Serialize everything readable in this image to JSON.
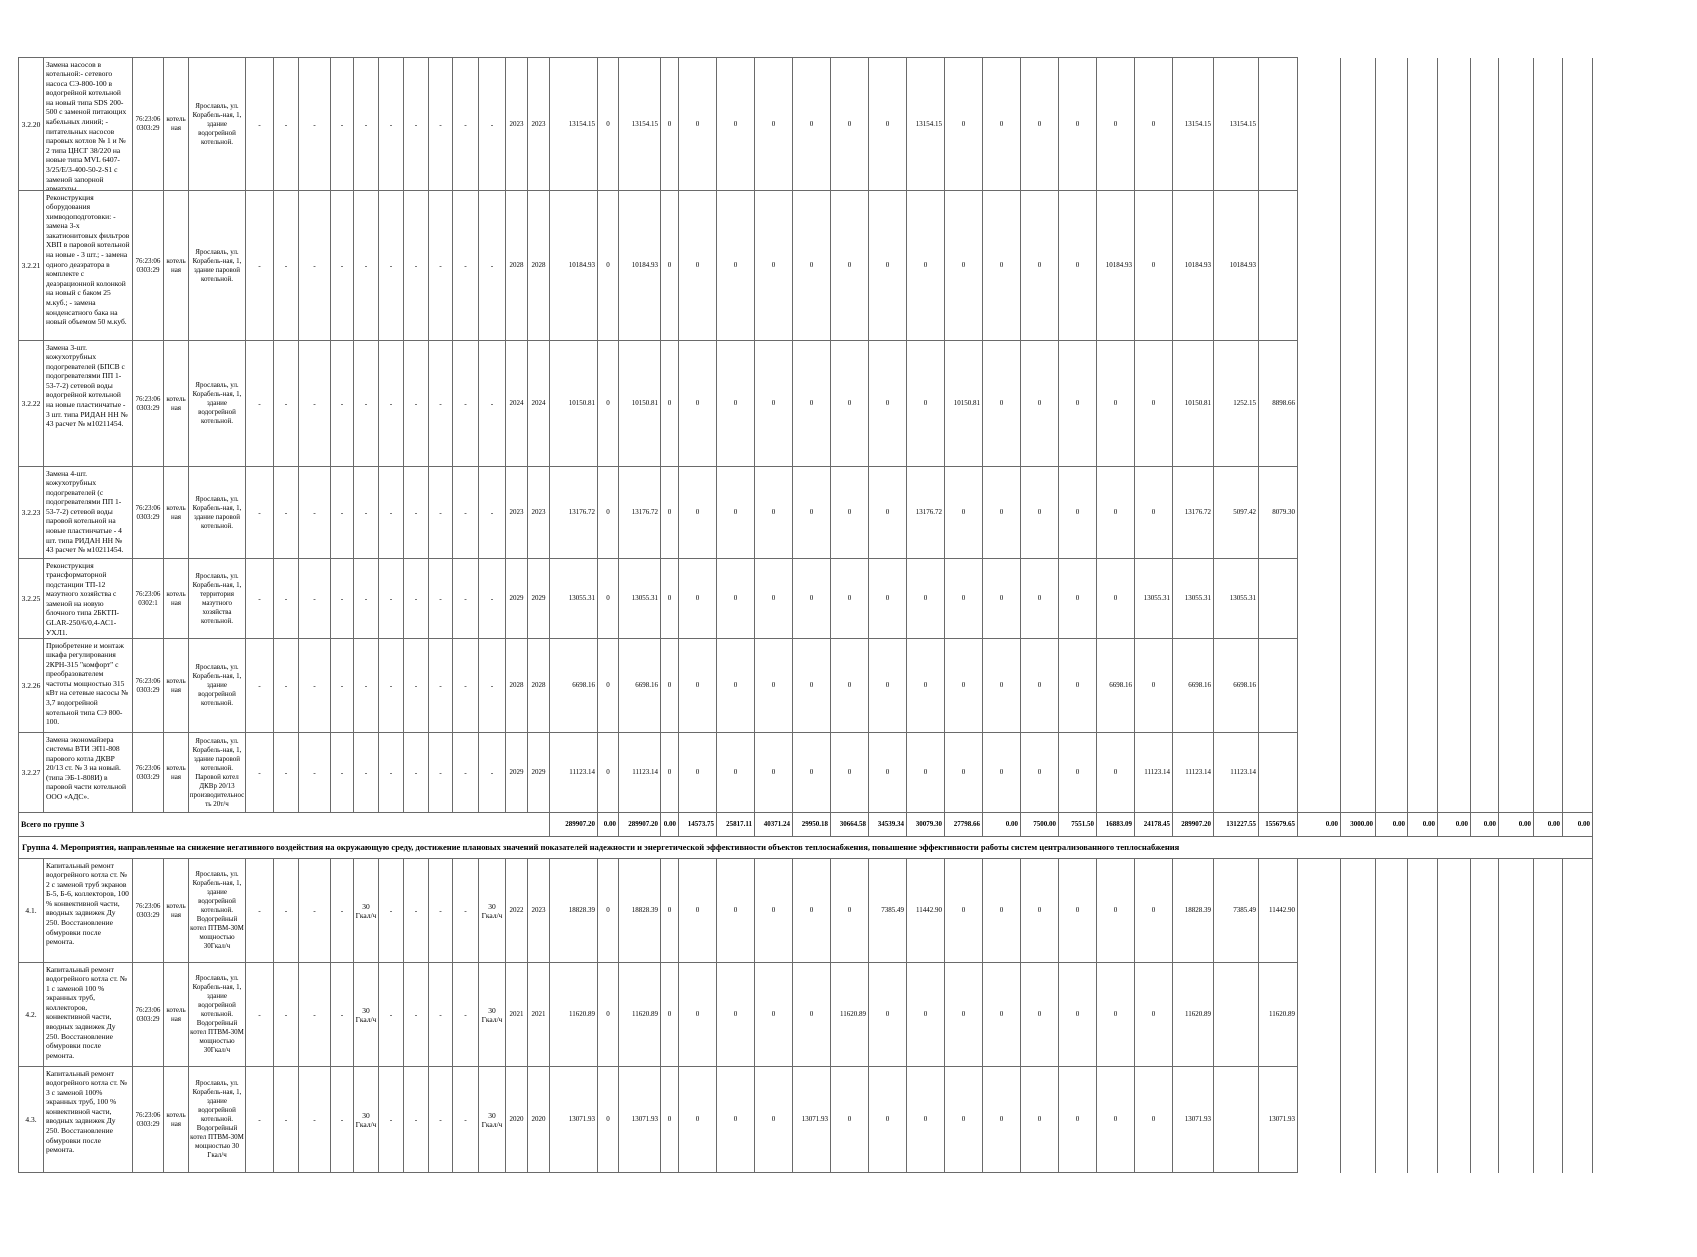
{
  "table": {
    "group4_header": "Группа 4. Мероприятия, направленные на снижение негативного воздействия на окружающую среду, достижение плановых значений показателей надежности и энергетической эффективности объектов теплоснабжения, повышение эффективности работы систем централизованного теплоснабжения",
    "rows": [
      {
        "kind": "item",
        "num": "3.2.20",
        "desc": "Замена насосов в котельной:- сетевого насоса СЭ-800-100 в водогрейной котельной на новый типа SDS 200-500 с заменой питающих кабельных линий;  - питательных насосов паровых котлов № 1 и № 2 типа ЦНСГ 38/220 на новые типа MVL 6407-3/25/Е/3-400-50-2-S1 с заменой запорной арматуры.",
        "cad": "76:23:06 0303:29",
        "type": "котель ная",
        "addr": "Ярославль, ул. Корабель-ная, 1, здание водогрейной котельной.",
        "d": [
          "-",
          "-",
          "-",
          "-",
          "-",
          "-",
          "-",
          "-",
          "-",
          "-"
        ],
        "year_start": "2023",
        "year_end": "2023",
        "c": [
          "13154.15",
          "0",
          "13154.15"
        ],
        "y": [
          "0",
          "0",
          "0",
          "0",
          "0",
          "0",
          "0",
          "13154.15",
          "0",
          "0",
          "0",
          "0",
          "0",
          "0"
        ],
        "sums": [
          "13154.15",
          "13154.15",
          ""
        ],
        "r": [
          "",
          "",
          "",
          "",
          "",
          "",
          "",
          "",
          ""
        ]
      },
      {
        "kind": "item",
        "num": "3.2.21",
        "desc": "Реконструкция оборудования химводоподготовки: - замена 3-х закатионитовых фильтров ХВП в паровой котельной на новые - 3 шт.;  - замена одного деаэратора в комплекте с деаэрационной колонкой на новый с баком 25 м.куб.; - замена конденсатного бака на новый объемом 50 м.куб.",
        "cad": "76:23:06 0303:29",
        "type": "котель ная",
        "addr": "Ярославль, ул. Корабель-ная, 1, здание паровой котельной.",
        "d": [
          "-",
          "-",
          "-",
          "-",
          "-",
          "-",
          "-",
          "-",
          "-",
          "-"
        ],
        "year_start": "2028",
        "year_end": "2028",
        "c": [
          "10184.93",
          "0",
          "10184.93"
        ],
        "y": [
          "0",
          "0",
          "0",
          "0",
          "0",
          "0",
          "0",
          "0",
          "0",
          "0",
          "0",
          "0",
          "10184.93",
          "0"
        ],
        "sums": [
          "10184.93",
          "10184.93",
          ""
        ],
        "r": [
          "",
          "",
          "",
          "",
          "",
          "",
          "",
          "",
          ""
        ]
      },
      {
        "kind": "item",
        "num": "3.2.22",
        "desc": "Замена 3-шт. кожухотрубных подогревателей (БПСВ с подогревателями ПП 1-53-7-2)  сетевой воды водогрейной котельной на новые пластинчатые - 3 шт. типа РИДАН НН № 43 расчет № м10211454.",
        "cad": "76:23:06 0303:29",
        "type": "котель ная",
        "addr": "Ярославль, ул. Корабель-ная, 1, здание водогрейной котельной.",
        "d": [
          "-",
          "-",
          "-",
          "-",
          "-",
          "-",
          "-",
          "-",
          "-",
          "-"
        ],
        "year_start": "2024",
        "year_end": "2024",
        "c": [
          "10150.81",
          "0",
          "10150.81"
        ],
        "y": [
          "0",
          "0",
          "0",
          "0",
          "0",
          "0",
          "0",
          "0",
          "10150.81",
          "0",
          "0",
          "0",
          "0",
          "0"
        ],
        "sums": [
          "10150.81",
          "1252.15",
          "8898.66"
        ],
        "r": [
          "",
          "",
          "",
          "",
          "",
          "",
          "",
          "",
          ""
        ]
      },
      {
        "kind": "item",
        "num": "3.2.23",
        "desc": "Замена 4-шт. кожухотрубных подогревателей (с подогревателями ПП 1-53-7-2)  сетевой воды паровой котельной на новые пластинчатые - 4 шт. типа РИДАН НН № 43 расчет № м10211454.",
        "cad": "76:23:06 0303:29",
        "type": "котель ная",
        "addr": "Ярославль, ул. Корабель-ная, 1, здание паровой котельной.",
        "d": [
          "-",
          "-",
          "-",
          "-",
          "-",
          "-",
          "-",
          "-",
          "-",
          "-"
        ],
        "year_start": "2023",
        "year_end": "2023",
        "c": [
          "13176.72",
          "0",
          "13176.72"
        ],
        "y": [
          "0",
          "0",
          "0",
          "0",
          "0",
          "0",
          "0",
          "13176.72",
          "0",
          "0",
          "0",
          "0",
          "0",
          "0"
        ],
        "sums": [
          "13176.72",
          "5097.42",
          "8079.30"
        ],
        "r": [
          "",
          "",
          "",
          "",
          "",
          "",
          "",
          "",
          ""
        ]
      },
      {
        "kind": "item",
        "num": "3.2.25",
        "desc": "Реконструкция трансформаторной подстанции ТП-12 мазутного хозяйства с заменой на новую блочного типа 2БКТП-GLAR-250/6/0,4-АС1-УХЛ1.",
        "cad": "76:23:06 0302:1",
        "type": "котель ная",
        "addr": "Ярославль, ул. Корабель-ная, 1, территория мазутного хозяйства котельной.",
        "d": [
          "-",
          "-",
          "-",
          "-",
          "-",
          "-",
          "-",
          "-",
          "-",
          "-"
        ],
        "year_start": "2029",
        "year_end": "2029",
        "c": [
          "13055.31",
          "0",
          "13055.31"
        ],
        "y": [
          "0",
          "0",
          "0",
          "0",
          "0",
          "0",
          "0",
          "0",
          "0",
          "0",
          "0",
          "0",
          "0",
          "13055.31"
        ],
        "sums": [
          "13055.31",
          "13055.31",
          ""
        ],
        "r": [
          "",
          "",
          "",
          "",
          "",
          "",
          "",
          "",
          ""
        ]
      },
      {
        "kind": "item",
        "num": "3.2.26",
        "desc": "Приобретение и монтаж шкафа регулирования 2КРН-315 \"комфорт\" с преобразователем частоты мощностью 315 кВт на сетевые насосы № 3,7 водогрейной котельной типа СЭ 800-100.",
        "cad": "76:23:06 0303:29",
        "type": "котель ная",
        "addr": "Ярославль, ул. Корабель-ная, 1, здание водогрейной котельной.",
        "d": [
          "-",
          "-",
          "-",
          "-",
          "-",
          "-",
          "-",
          "-",
          "-",
          "-"
        ],
        "year_start": "2028",
        "year_end": "2028",
        "c": [
          "6698.16",
          "0",
          "6698.16"
        ],
        "y": [
          "0",
          "0",
          "0",
          "0",
          "0",
          "0",
          "0",
          "0",
          "0",
          "0",
          "0",
          "0",
          "6698.16",
          "0"
        ],
        "sums": [
          "6698.16",
          "6698.16",
          ""
        ],
        "r": [
          "",
          "",
          "",
          "",
          "",
          "",
          "",
          "",
          ""
        ]
      },
      {
        "kind": "item",
        "num": "3.2.27",
        "desc": "Замена экономайзера системы ВТИ ЭП1-808 парового котла ДКВР 20/13 ст. № 3 на новый. (типа ЭБ-1-808И) в паровой части котельной ООО «АДС».",
        "cad": "76:23:06 0303:29",
        "type": "котель ная",
        "addr": "Ярославль, ул. Корабель-ная, 1, здание паровой котельной. Паровой котел ДКВр 20/13 производительность 20т/ч",
        "d": [
          "-",
          "-",
          "-",
          "-",
          "-",
          "-",
          "-",
          "-",
          "-",
          "-"
        ],
        "year_start": "2029",
        "year_end": "2029",
        "c": [
          "11123.14",
          "0",
          "11123.14"
        ],
        "y": [
          "0",
          "0",
          "0",
          "0",
          "0",
          "0",
          "0",
          "0",
          "0",
          "0",
          "0",
          "0",
          "0",
          "11123.14"
        ],
        "sums": [
          "11123.14",
          "11123.14",
          ""
        ],
        "r": [
          "",
          "",
          "",
          "",
          "",
          "",
          "",
          "",
          ""
        ]
      },
      {
        "kind": "total",
        "label": "Всего по группе 3",
        "c": [
          "289907.20",
          "0.00",
          "289907.20"
        ],
        "y": [
          "0.00",
          "14573.75",
          "25817.11",
          "40371.24",
          "29950.18",
          "30664.58",
          "34539.34",
          "30079.30",
          "27798.66",
          "0.00",
          "7500.00",
          "7551.50",
          "16883.09",
          "24178.45"
        ],
        "sums": [
          "289907.20",
          "131227.55",
          "155679.65"
        ],
        "r": [
          "0.00",
          "3000.00",
          "0.00",
          "0.00",
          "0.00",
          "0.00",
          "0.00",
          "0.00",
          "0.00"
        ]
      },
      {
        "kind": "group",
        "label": "Группа 4. Мероприятия, направленные на снижение негативного воздействия на окружающую среду, достижение плановых значений показателей надежности и энергетической эффективности объектов теплоснабжения, повышение эффективности работы систем централизованного теплоснабжения"
      },
      {
        "kind": "item",
        "num": "4.1.",
        "desc": "Капитальный ремонт водогрейного котла ст. № 2 с заменой труб экранов Б-5, Б-6, коллекторов, 100 % конвективной части, вводных задвижек Ду 250. Восстановление обмуровки после ремонта.",
        "cad": "76:23:06 0303:29",
        "type": "котель ная",
        "addr": "Ярославль, ул. Корабель-ная, 1, здание водогрейной котельной. Водогрейный котел ПТВМ-30М мощностью 30Гкал/ч",
        "d": [
          "-",
          "-",
          "-",
          "-",
          "30 Гкал/ч",
          "-",
          "-",
          "-",
          "-",
          "30 Гкал/ч"
        ],
        "year_start": "2022",
        "year_end": "2023",
        "c": [
          "18828.39",
          "0",
          "18828.39"
        ],
        "y": [
          "0",
          "0",
          "0",
          "0",
          "0",
          "0",
          "7385.49",
          "11442.90",
          "0",
          "0",
          "0",
          "0",
          "0",
          "0"
        ],
        "sums": [
          "18828.39",
          "7385.49",
          "11442.90"
        ],
        "r": [
          "",
          "",
          "",
          "",
          "",
          "",
          "",
          "",
          ""
        ]
      },
      {
        "kind": "item",
        "num": "4.2.",
        "desc": "Капитальный ремонт водогрейного котла ст. № 1 с заменой 100 % экранных труб, коллекторов, конвективной части, вводных задвижек Ду 250. Восстановление обмуровки после ремонта.",
        "cad": "76:23:06 0303:29",
        "type": "котель ная",
        "addr": "Ярославль, ул. Корабель-ная, 1, здание водогрейной котельной. Водогрейный котел ПТВМ-30М мощностью 30Гкал/ч",
        "d": [
          "-",
          "-",
          "-",
          "-",
          "30 Гкал/ч",
          "-",
          "-",
          "-",
          "-",
          "30 Гкал/ч"
        ],
        "year_start": "2021",
        "year_end": "2021",
        "c": [
          "11620.89",
          "0",
          "11620.89"
        ],
        "y": [
          "0",
          "0",
          "0",
          "0",
          "0",
          "11620.89",
          "0",
          "0",
          "0",
          "0",
          "0",
          "0",
          "0",
          "0"
        ],
        "sums": [
          "11620.89",
          "",
          "11620.89"
        ],
        "r": [
          "",
          "",
          "",
          "",
          "",
          "",
          "",
          "",
          ""
        ]
      },
      {
        "kind": "item",
        "num": "4.3.",
        "desc": "Капитальный ремонт водогрейного котла ст. № 3 с заменой 100% экранных труб, 100 % конвективной части, вводных задвижек Ду 250. Восстановление обмуровки после ремонта.",
        "cad": "76:23:06 0303:29",
        "type": "котель ная",
        "addr": "Ярославль, ул. Корабель-ная, 1, здание водогрейной котельной. Водогрейный котел ПТВМ-30М мощностью 30 Гкал/ч",
        "d": [
          "-",
          "-",
          "-",
          "-",
          "30 Гкал/ч",
          "-",
          "-",
          "-",
          "-",
          "30 Гкал/ч"
        ],
        "year_start": "2020",
        "year_end": "2020",
        "c": [
          "13071.93",
          "0",
          "13071.93"
        ],
        "y": [
          "0",
          "0",
          "0",
          "0",
          "13071.93",
          "0",
          "0",
          "0",
          "0",
          "0",
          "0",
          "0",
          "0",
          "0"
        ],
        "sums": [
          "13071.93",
          "",
          "13071.93"
        ],
        "r": [
          "",
          "",
          "",
          "",
          "",
          "",
          "",
          "",
          ""
        ]
      }
    ]
  }
}
